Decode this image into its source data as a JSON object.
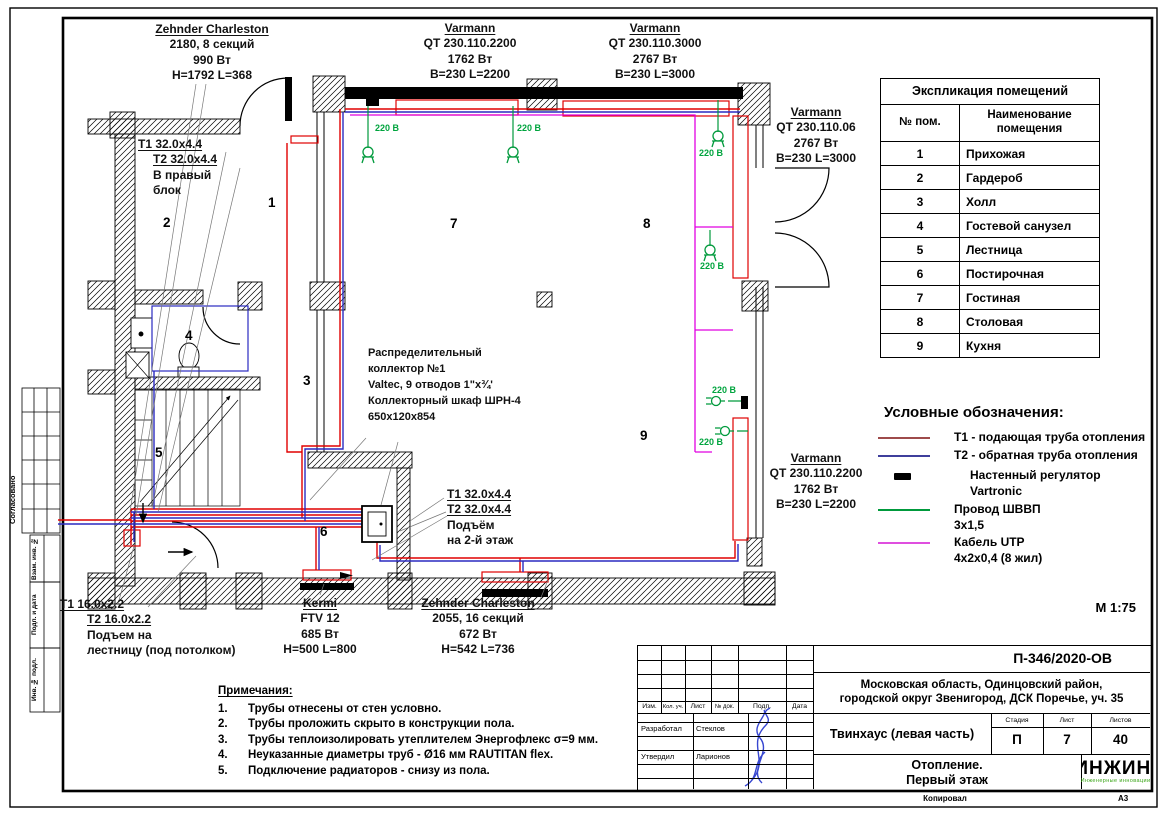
{
  "misc": {
    "scale": "М 1:75",
    "copied": "Копировал",
    "format": "А3"
  },
  "colors": {
    "pipe_t1": "#e00000",
    "pipe_t2": "#2a2ac0",
    "cable_utp": "#e100e1",
    "wire_shvvp": "#009a3c",
    "legend_t1": "#9e4b4b",
    "legend_t2": "#3f3f9c",
    "label_220": "#00a43e",
    "logo_green": "#3aa517",
    "signature": "#2233cc"
  },
  "side_stamp": {
    "agreed": "Согласовано",
    "vzam": "Взам. инв. №",
    "podp": "Подп. и дата",
    "inv": "Инв. № подл."
  },
  "plan": {
    "v220": "220 В",
    "room_numbers": [
      "1",
      "2",
      "3",
      "4",
      "5",
      "6",
      "7",
      "8",
      "9"
    ],
    "labels": {
      "zehnder2180": [
        "Zehnder Charleston",
        "2180, 8 секций",
        "990 Вт",
        "H=1792 L=368"
      ],
      "right_block": [
        "Т1 32.0x4.4",
        "Т2 32.0x4.4",
        "В правый",
        "блок"
      ],
      "varmann2200_top": [
        "Varmann",
        "QT 230.110.2200",
        "1762 Вт",
        "B=230 L=2200"
      ],
      "varmann3000_top": [
        "Varmann",
        "QT 230.110.3000",
        "2767 Вт",
        "B=230 L=3000"
      ],
      "varmann06_right": [
        "Varmann",
        "QT 230.110.06",
        "2767 Вт",
        "B=230 L=3000"
      ],
      "varmann2200_right": [
        "Varmann",
        "QT 230.110.2200",
        "1762 Вт",
        "B=230 L=2200"
      ],
      "collector": [
        "Распределительный",
        "коллектор №1",
        "Valtec, 9 отводов 1\"х¾'",
        "Коллекторный шкаф ШРН-4",
        "650х120х854"
      ],
      "riser2": [
        "Т1 32.0x4.4",
        "Т2 32.0х4.4",
        "Подъём",
        "на 2-й этаж"
      ],
      "riser_stairs": [
        "Т1 16.0x2.2",
        "Т2 16.0x2.2",
        "Подъем на",
        "лестницу (под потолком)"
      ],
      "kermi": [
        "Kermi",
        "FTV 12",
        "685 Вт",
        "H=500 L=800"
      ],
      "zehnder2055": [
        "Zehnder Charleston",
        "2055, 16 секций",
        "672 Вт",
        "H=542 L=736"
      ]
    }
  },
  "room_table": {
    "title": "Экспликация помещений",
    "col_num": "№ пом.",
    "col_name_l1": "Наименование",
    "col_name_l2": "помещения",
    "rows": [
      {
        "num": "1",
        "name": "Прихожая"
      },
      {
        "num": "2",
        "name": "Гардероб"
      },
      {
        "num": "3",
        "name": "Холл"
      },
      {
        "num": "4",
        "name": "Гостевой санузел"
      },
      {
        "num": "5",
        "name": "Лестница"
      },
      {
        "num": "6",
        "name": "Постирочная"
      },
      {
        "num": "7",
        "name": "Гостиная"
      },
      {
        "num": "8",
        "name": "Столовая"
      },
      {
        "num": "9",
        "name": "Кухня"
      }
    ]
  },
  "legend": {
    "title": "Условные обозначения:",
    "items": [
      {
        "label": "Т1 - подающая труба отопления"
      },
      {
        "label": "Т2 - обратная труба отопления"
      },
      {
        "label": "Настенный регулятор",
        "label2": "Vartronic"
      },
      {
        "label": "Провод ШВВП",
        "label2": "3х1,5"
      },
      {
        "label": "Кабель UTP",
        "label2": "4х2х0,4 (8 жил)"
      }
    ]
  },
  "notes": {
    "title": "Примечания:",
    "items": [
      {
        "num": "1.",
        "text": "Трубы отнесены от стен условно."
      },
      {
        "num": "2.",
        "text": "Трубы проложить скрыто в конструкции пола."
      },
      {
        "num": "3.",
        "text": "Трубы теплоизолировать утеплителем Энергофлекс σ=9 мм."
      },
      {
        "num": "4.",
        "text": "Неуказанные диаметры труб - Ø16 мм RAUTITAN flex."
      },
      {
        "num": "5.",
        "text": "Подключение радиаторов - снизу из пола."
      }
    ]
  },
  "title_block": {
    "doc_number": "П-346/2020-ОВ",
    "address_l1": "Московская область, Одинцовский район,",
    "address_l2": "городской округ Звенигород, ДСК Поречье, уч. 35",
    "object": "Твинхаус (левая часть)",
    "sheet_title_l1": "Отопление.",
    "sheet_title_l2": "Первый этаж",
    "stage_label": "Стадия",
    "sheet_label": "Лист",
    "sheets_label": "Листов",
    "stage": "П",
    "sheet": "7",
    "sheets": "40",
    "cols": [
      "Изм.",
      "Кол. уч.",
      "Лист",
      "№ док.",
      "Подп.",
      "Дата"
    ],
    "developed_label": "Разработал",
    "developed_name": "Стеклов",
    "approved_label": "Утвердил",
    "approved_name": "Ларионов",
    "logo": "ИНЖИН",
    "logo_r": "®",
    "logo_sub": "Инженерные инновации"
  }
}
